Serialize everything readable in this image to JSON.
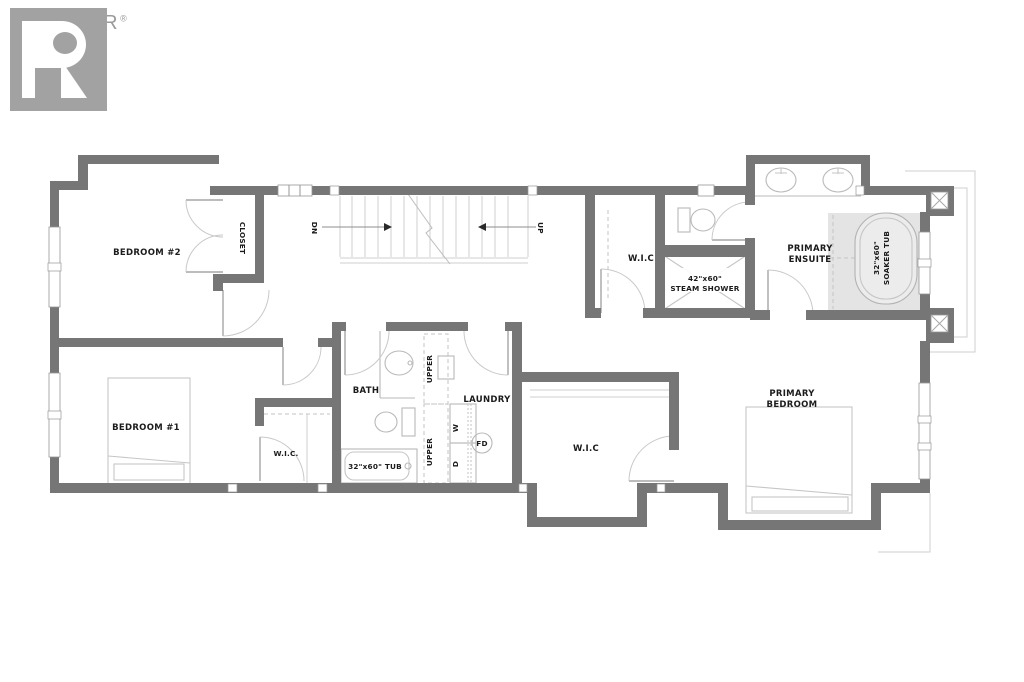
{
  "logo": {
    "brand": "REALTOR",
    "registered": "®"
  },
  "colors": {
    "wall": "#767676",
    "fixture_line": "#b9b9b9",
    "tub_fill": "#e4e4e4",
    "label_text": "#1b1b1b",
    "logo_gray": "#9b9b9b"
  },
  "rooms": {
    "bedroom2": {
      "label": "BEDROOM #2"
    },
    "closet": {
      "label": "CLOSET"
    },
    "stairs": {
      "down_label": "DN",
      "up_label": "UP"
    },
    "wic_top": {
      "label": "W.I.C"
    },
    "steam_shower": {
      "size": "42\"x60\"",
      "label": "STEAM SHOWER"
    },
    "primary_ensuite": {
      "label_line1": "PRIMARY",
      "label_line2": "ENSUITE"
    },
    "soaker_tub": {
      "size": "32\"x60\"",
      "label": "SOAKER TUB"
    },
    "bedroom1": {
      "label": "BEDROOM #1"
    },
    "wic_bedroom1": {
      "label": "W.I.C."
    },
    "bath": {
      "label": "BATH",
      "tub_label": "32\"x60\" TUB"
    },
    "laundry": {
      "label": "LAUNDRY",
      "upper_cabinet_top": "UPPER",
      "upper_cabinet_bottom": "UPPER",
      "washer": "W",
      "dryer": "D",
      "floor_drain": "FD"
    },
    "wic_center": {
      "label": "W.I.C"
    },
    "primary_bedroom": {
      "label_line1": "PRIMARY",
      "label_line2": "BEDROOM"
    }
  }
}
